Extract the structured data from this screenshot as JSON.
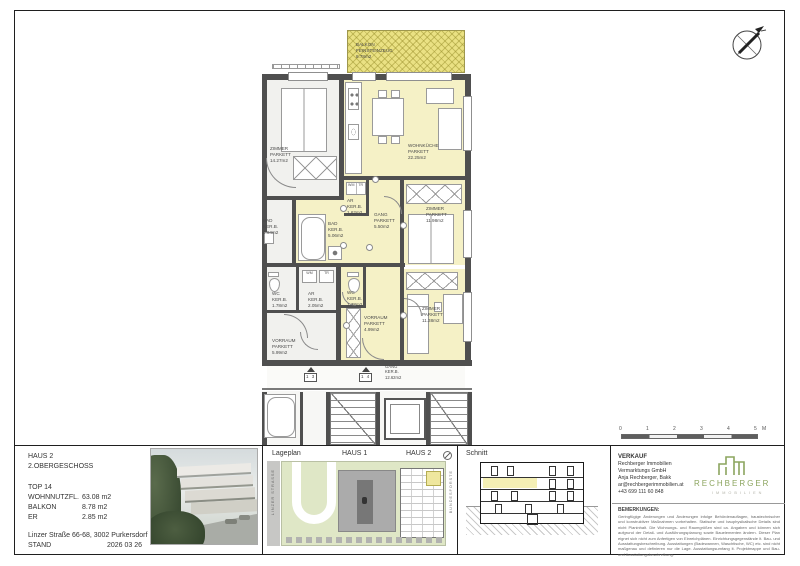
{
  "titleblock": {
    "haus": "HAUS 2",
    "floor": "2.OBERGESCHOSS",
    "top": "TOP 14",
    "areas": [
      {
        "label": "WOHNNUTZFL.",
        "value": "63.08 m2"
      },
      {
        "label": "BALKON",
        "value": "8.78 m2"
      },
      {
        "label": "ER",
        "value": "2.85 m2"
      }
    ],
    "address": "Linzer Straße 66-68, 3002 Purkersdorf",
    "stand_label": "STAND",
    "stand_value": "2026 03 26"
  },
  "plan": {
    "rooms": [
      {
        "name": "BALKON",
        "floor": "FEINSTEINZEUG",
        "area": "8.78m2"
      },
      {
        "name": "WOHNKÜCHE",
        "floor": "PARKETT",
        "area": "22.25m2"
      },
      {
        "name": "ZIMMER",
        "floor": "PARKETT",
        "area": "14.27m2"
      },
      {
        "name": "AR",
        "floor": "KER.B.",
        "area": "1.62m2"
      },
      {
        "name": "GANG",
        "floor": "PARKETT",
        "area": "5.50m2"
      },
      {
        "name": "BAD",
        "floor": "KER.B.",
        "area": "5.06m2"
      },
      {
        "name": "ZIMMER",
        "floor": "PARKETT",
        "area": "11.98m2"
      },
      {
        "name": "WC",
        "floor": "KER.B.",
        "area": "1.38m2"
      },
      {
        "name": "VORRAUM",
        "floor": "PARKETT",
        "area": "4.99m2"
      },
      {
        "name": "ZIMMER",
        "floor": "PARKETT",
        "area": "11.38m2"
      },
      {
        "name": "BAD",
        "floor": "KER.B.",
        "area": "4.94m2"
      },
      {
        "name": "WC",
        "floor": "KER.B.",
        "area": "1.78m2"
      },
      {
        "name": "AR",
        "floor": "KER.B.",
        "area": "2.05m2"
      },
      {
        "name": "VORRAUM",
        "floor": "PARKETT",
        "area": "5.99m2"
      },
      {
        "name": "GANG",
        "floor": "KER.B.",
        "area": "12.62m2"
      }
    ],
    "door_tags": [
      "1 3",
      "1 4"
    ],
    "labels": {
      "wm": "WM",
      "tr": "TR"
    }
  },
  "scalebar": {
    "ticks": [
      "0",
      "1",
      "2",
      "3",
      "4",
      "5"
    ],
    "unit": "M"
  },
  "lageplan": {
    "title": "Lageplan",
    "haus1": "HAUS 1",
    "haus2": "HAUS 2",
    "street": "LINZER STRASSE",
    "forest": "BUNDESFORSTE"
  },
  "schnitt": {
    "title": "Schnitt"
  },
  "verkauf": {
    "title": "VERKAUF",
    "lines": [
      "Rechberger Immobilien",
      "Vermarktungs GmbH",
      "Anja Rechberger, Bakk",
      "ar@rechbergerimmobilien.at",
      "+43 699 111 60 848"
    ]
  },
  "logo": {
    "name": "RECHBERGER",
    "sub": "IMMOBILIEN"
  },
  "bemerkungen": {
    "title": "BEMERKUNGEN:",
    "text": "Geringfügige Änderungen und Änderungen infolge Behördenauflagen, haustechnischer und konstruktiver Maßnahmen vorbehalten. Statische und bauphysikalische Details sind nicht Planinhalt. Die Wohnungs- und Raumgrößen sind ca. Angaben und können sich aufgrund der Detail- und Ausführungsplanung sowie Bauelementen ändern. Dieser Plan eignet sich nicht zum Anfertigen von Einreichplänen. Einrichtungsgegenstände lt. Bau- und Ausstattungsbeschreibung. Ausstattungen (Badewannen, Waschtische, WC) etc. sind nicht maßgenau und definieren nur die Lage. Ausstattungsumfang lt. Projektmappe und Bau- und Ausstattungsbeschreibung."
  }
}
